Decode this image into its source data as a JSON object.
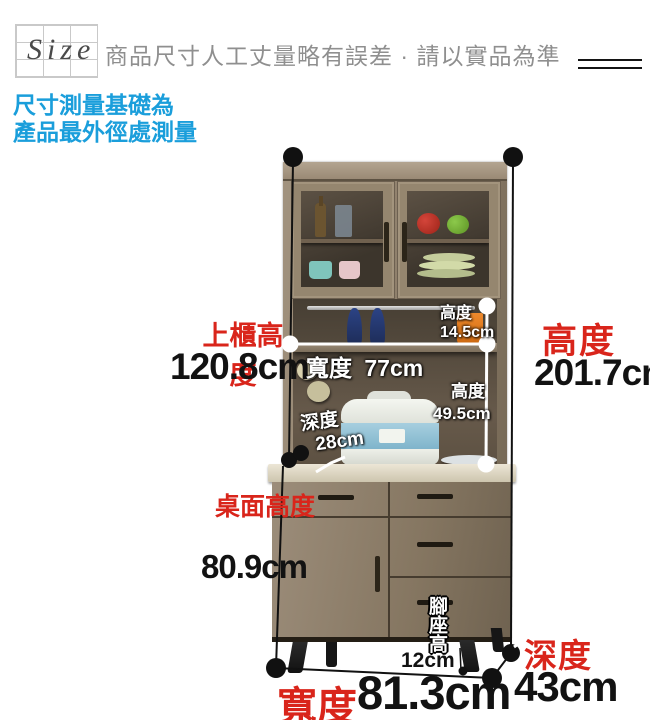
{
  "header": {
    "size_label": "Size",
    "note": "商品尺寸人工丈量略有誤差 · 請以實品為準"
  },
  "measurement_note": {
    "line1": "尺寸測量基礎為",
    "line2": "產品最外徑處測量"
  },
  "dimensions": {
    "upper_height_label": "上櫃高度",
    "upper_height_value": "120.8cm",
    "inner_width_label": "寬度",
    "inner_width_value": "77cm",
    "shelf_height_label": "高度",
    "shelf_height_value": "14.5cm",
    "open_height_label": "高度",
    "open_height_value": "49.5cm",
    "inner_depth_label": "深度",
    "inner_depth_value": "28cm",
    "desk_height_label": "桌面高度",
    "desk_height_value": "80.9cm",
    "total_height_label": "高度",
    "total_height_value": "201.7cm",
    "foot_height_label": "腳座高",
    "foot_height_value": "12cm",
    "width_label": "寬度",
    "width_value": "81.3cm",
    "depth_label": "深度",
    "depth_value": "43cm"
  },
  "colors": {
    "accent_red": "#d9251b",
    "accent_blue": "#1a9edb",
    "wood": "#93846f"
  }
}
